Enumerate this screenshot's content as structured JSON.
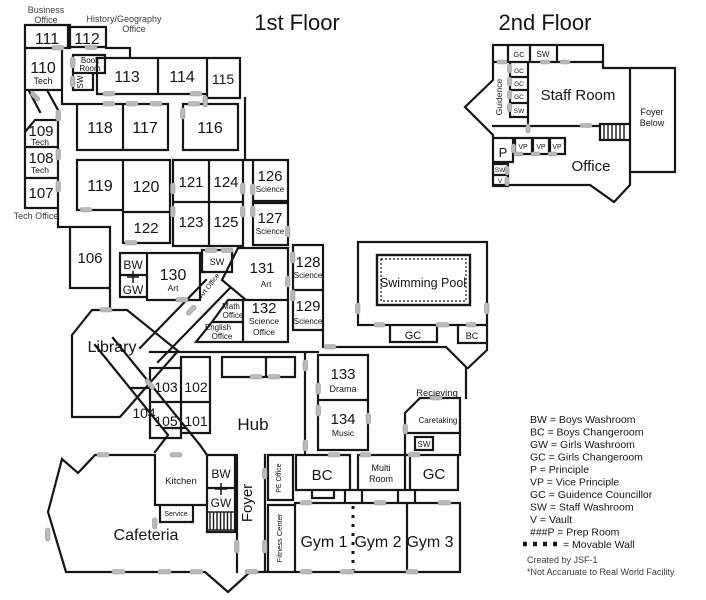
{
  "titles": {
    "first_floor": "1st Floor",
    "second_floor": "2nd Floor"
  },
  "f1": {
    "business_office_1": "Business",
    "business_office_2": "Office",
    "history_office_1": "History/Geography",
    "history_office_2": "Office",
    "tech_office": "Tech Office",
    "r111": "111",
    "r112": "112",
    "r110": "110",
    "r110_sub": "Tech",
    "book_room_1": "Book",
    "book_room_2": "Room",
    "book_sw": "SW",
    "r113": "113",
    "r114": "114",
    "r115": "115",
    "r109": "109",
    "r109_sub": "Tech",
    "r108": "108",
    "r108_sub": "Tech",
    "r107": "107",
    "r118": "118",
    "r117": "117",
    "r116": "116",
    "r119": "119",
    "r120": "120",
    "r122": "122",
    "r121": "121",
    "r124": "124",
    "r123": "123",
    "r125": "125",
    "r126": "126",
    "r126_sub": "Science",
    "r127": "127",
    "r127_sub": "Science",
    "r128": "128",
    "r128_sub": "Science",
    "r129": "129",
    "r129_sub": "Science",
    "r106": "106",
    "bw": "BW",
    "gw": "GW",
    "r130": "130",
    "r130_sub": "Art",
    "sw_art": "SW",
    "art_office": "Art Office",
    "r131": "131",
    "r131_sub": "Art",
    "math_office_1": "Math",
    "math_office_2": "Office",
    "english_office_1": "English",
    "english_office_2": "Office",
    "r132": "132",
    "r132_sub1": "Science",
    "r132_sub2": "Office",
    "library": "Library",
    "swimming_pool": "Swimming Pool",
    "pool_gc": "GC",
    "pool_bc": "BC",
    "r133": "133",
    "r133_sub": "Drama",
    "r134": "134",
    "r134_sub": "Music",
    "recieving": "Recieving",
    "caretaking": "Caretaking",
    "caretaking_sw": "SW",
    "hub": "Hub",
    "r103": "103",
    "r102": "102",
    "r105": "105",
    "r101": "101",
    "r104": "104",
    "kitchen": "Kitchen",
    "service": "Service",
    "bw2": "BW",
    "gw2": "GW",
    "foyer": "Foyer",
    "pe_office": "PE Office",
    "fitness_center": "Fitness Center",
    "cafeteria": "Cafeteria",
    "bc": "BC",
    "multi_room_1": "Multi",
    "multi_room_2": "Room",
    "gc": "GC",
    "gym1": "Gym 1",
    "gym2": "Gym 2",
    "gym3": "Gym 3"
  },
  "f2": {
    "gc_top": "GC",
    "sw_top": "SW",
    "guidence": "Guidence",
    "gc1": "GC",
    "gc2": "GC",
    "gc3": "GC",
    "sw1": "SW",
    "staff_room": "Staff Room",
    "foyer_below_1": "Foyer",
    "foyer_below_2": "Below",
    "p": "P",
    "vp1": "VP",
    "vp2": "VP",
    "vp3": "VP",
    "sw2": "SW",
    "v": "V",
    "office": "Office"
  },
  "legend": {
    "lines": [
      "BW =  Boys Washroom",
      "BC = Boys Changeroom",
      "GW = Girls Washroom",
      "GC = Girls Changeroom",
      "P = Principle",
      "VP = Vice Principle",
      "GC = Guidence Councillor",
      "SW = Staff Washroom",
      "V = Vault",
      "###P = Prep Room"
    ],
    "movable_wall": "= Movable Wall",
    "credit_1": "Created by JSF-1",
    "credit_2": "*Not Accaruate to Real World Facility"
  }
}
